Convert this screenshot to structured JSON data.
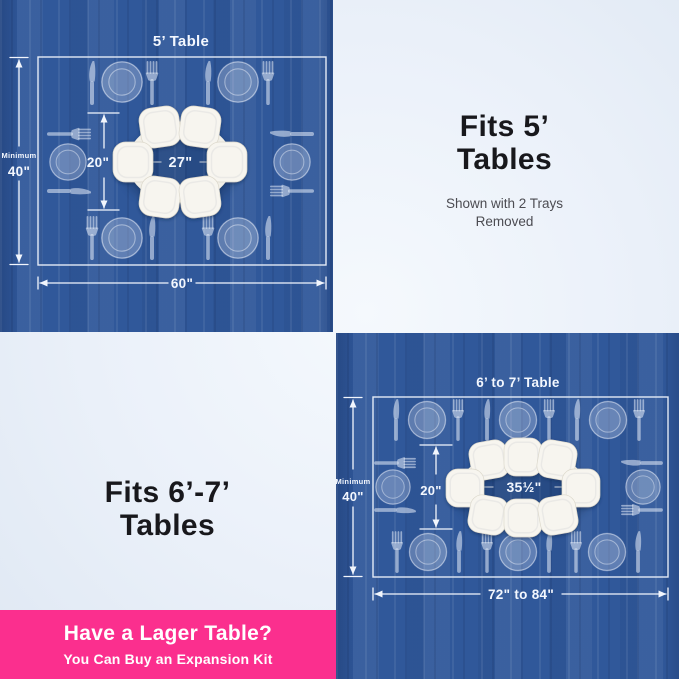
{
  "colors": {
    "wood_blue": "#30589a",
    "panel_light": "#e9effa",
    "banner_pink": "#fb2f8e",
    "diagram_line": "#f2f6fd",
    "tray_white": "#f7f5ef",
    "heading_text": "#18181c",
    "subtext_gray": "#4c4c52",
    "banner_text": "#ffffff"
  },
  "icons": {
    "plate": "plate-icon",
    "fork": "fork-icon",
    "knife": "knife-icon",
    "tray": "tray-icon"
  },
  "five_ft": {
    "title": "5’ Table",
    "min_label": "Minimum",
    "min_value": "40\"",
    "ring_height": "20\"",
    "ring_width": "27\"",
    "table_width": "60\"",
    "tray_count": 6,
    "place_setting_count": 6
  },
  "fits_5": {
    "heading": "Fits 5’\nTables",
    "subtext": "Shown with 2 Trays\nRemoved"
  },
  "fits_67": {
    "heading": "Fits 6’-7’\nTables"
  },
  "six_seven_ft": {
    "title": "6’ to 7’ Table",
    "min_label": "Minimum",
    "min_value": "40\"",
    "ring_height": "20\"",
    "ring_width": "35½\"",
    "table_width": "72\" to 84\"",
    "tray_count": 8,
    "place_setting_count": 8
  },
  "banner": {
    "heading": "Have a Lager Table?",
    "subtext": "You Can Buy an Expansion Kit"
  }
}
